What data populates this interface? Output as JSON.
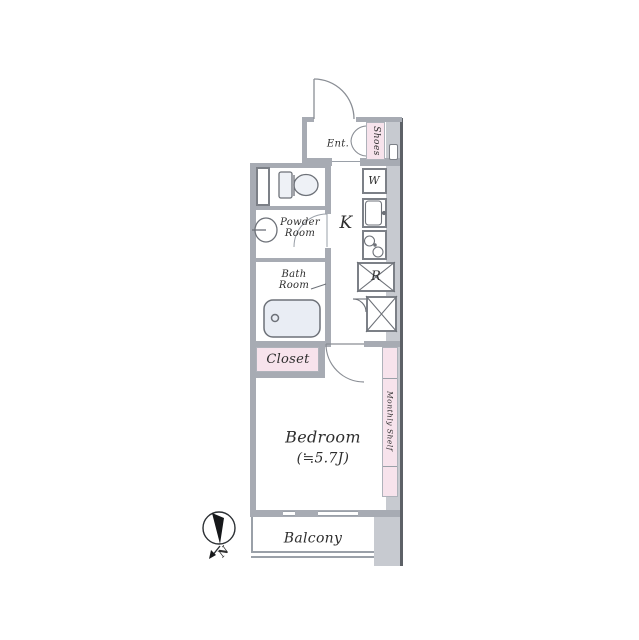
{
  "plan_type": "apartment-floor-plan",
  "colors": {
    "wall": "#a7abb3",
    "wall_light": "#c7cad0",
    "wall_dark": "#5d6167",
    "accent_pink": "#f7e3ec",
    "fixture_fill": "#e9edf4",
    "line": "#6d7178",
    "text": "#2e2e2e"
  },
  "rooms": {
    "entrance": {
      "label": "Ent."
    },
    "shoes": {
      "label": "Shoes"
    },
    "powder_room": {
      "line1": "Powder",
      "line2": "Room"
    },
    "bath_room": {
      "line1": "Bath",
      "line2": "Room"
    },
    "kitchen": {
      "label": "K"
    },
    "closet": {
      "label": "Closet"
    },
    "bedroom": {
      "label": "Bedroom",
      "size": "(≒5.7J)"
    },
    "shelf": {
      "label": "Monthly Shelf"
    },
    "balcony": {
      "label": "Balcony"
    }
  },
  "fixtures": {
    "washer": {
      "label": "W"
    },
    "refrigerator": {
      "label": "R"
    }
  },
  "compass": {
    "north_label": "N"
  }
}
